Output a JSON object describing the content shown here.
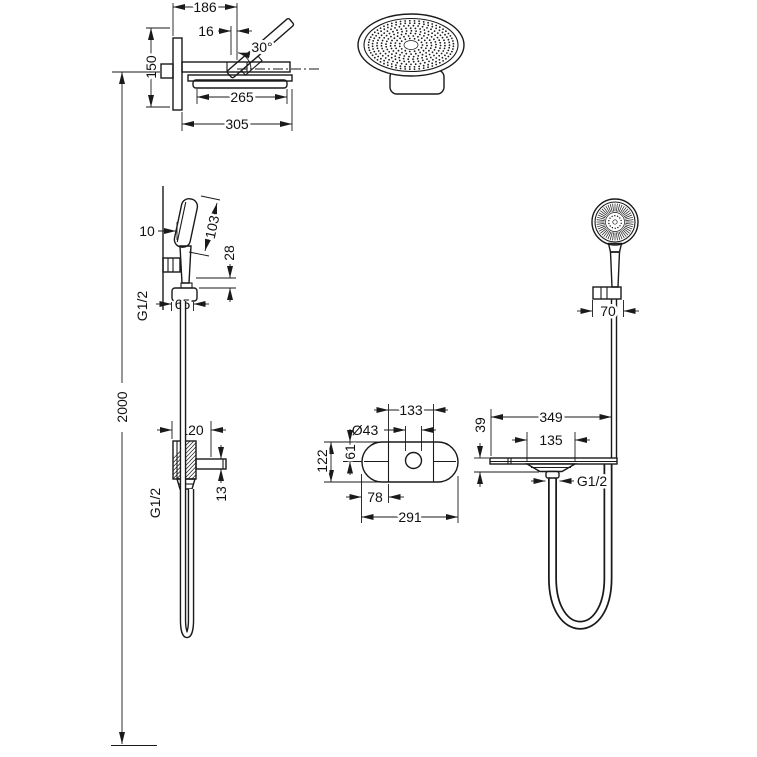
{
  "page": {
    "background": "#ffffff",
    "line_color": "#1a1a1a"
  },
  "drawing_type": "shower-system-dimensional-drawing",
  "dims": {
    "d186": "186",
    "d16": "16",
    "a30": "30°",
    "d150": "150",
    "d265": "265",
    "d305": "305",
    "d10": "10",
    "d103": "103",
    "d28": "28",
    "g12_hand": "G1/2",
    "d65": "65",
    "d2000": "2000",
    "d120": "120",
    "d13": "13",
    "g12_wall": "G1/2",
    "d133": "133",
    "d43": "Ø43",
    "d61": "61",
    "d122": "122",
    "d78": "78",
    "d291": "291",
    "d70": "70",
    "d349": "349",
    "d39": "39",
    "d135": "135",
    "g12_shelf": "G1/2"
  }
}
